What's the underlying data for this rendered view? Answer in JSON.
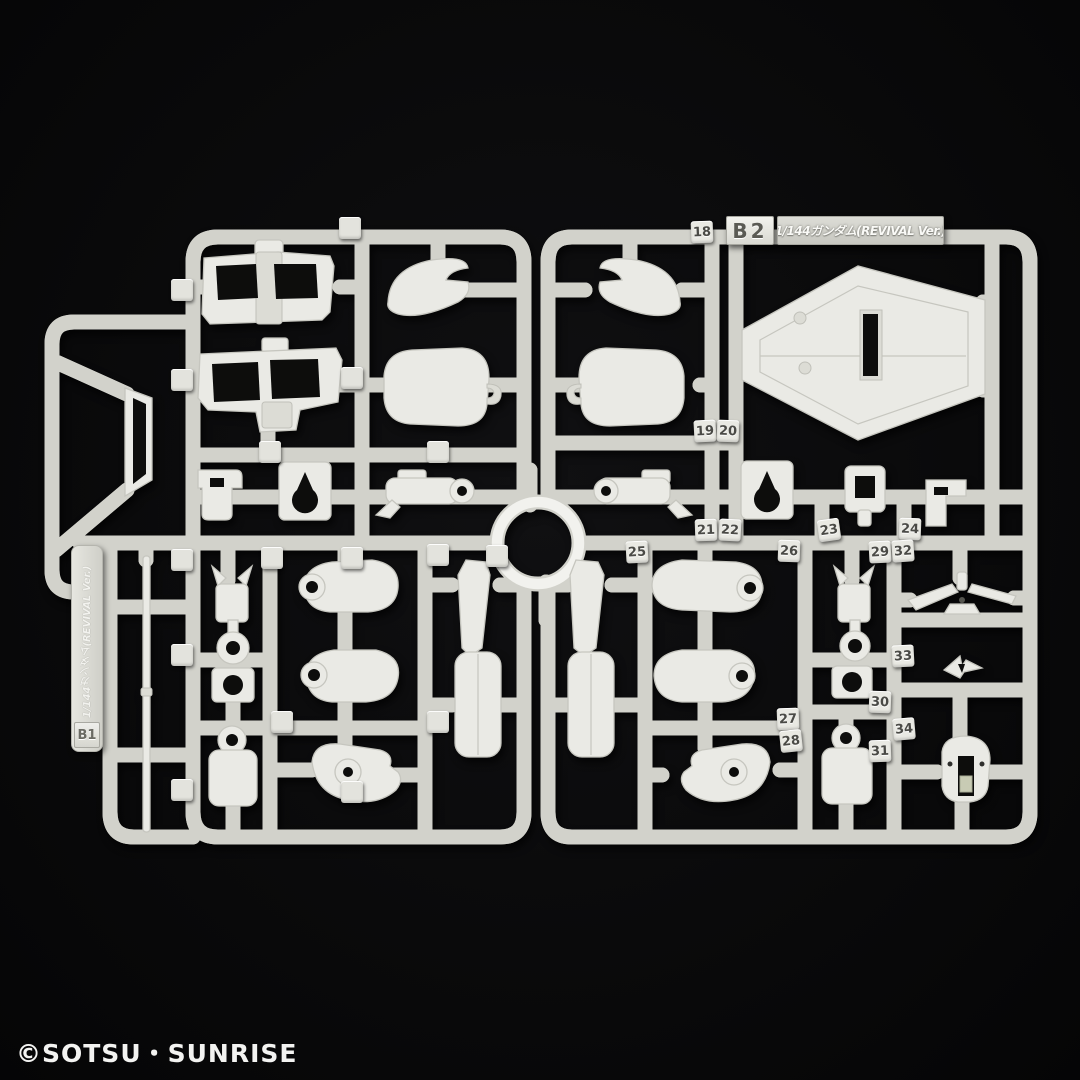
{
  "colors": {
    "background": "#0a0a0b",
    "tube_light": "#f2f2ee",
    "part_fill": "#eaeae5",
    "part_stroke": "#c6c6bf",
    "tag_fill": "#e9e9e3",
    "tag_text": "#4a4a46"
  },
  "runner_b1": {
    "code": "B1",
    "label": "1/144ガンダム(REVIVAL Ver.)"
  },
  "runner_b2": {
    "code": "B2",
    "label": "1/144ガンダム(REVIVAL Ver.)"
  },
  "footer": {
    "copyright": "©SOTSU・SUNRISE"
  },
  "part_number_tags": [
    {
      "n": "18",
      "x": 702,
      "y": 232,
      "r": -2
    },
    {
      "n": "19",
      "x": 705,
      "y": 431,
      "r": -3
    },
    {
      "n": "20",
      "x": 728,
      "y": 431,
      "r": 2
    },
    {
      "n": "21",
      "x": 706,
      "y": 530,
      "r": -2
    },
    {
      "n": "22",
      "x": 730,
      "y": 530,
      "r": 3
    },
    {
      "n": "23",
      "x": 829,
      "y": 530,
      "r": -8
    },
    {
      "n": "24",
      "x": 910,
      "y": 529,
      "r": 2
    },
    {
      "n": "25",
      "x": 637,
      "y": 552,
      "r": -3
    },
    {
      "n": "26",
      "x": 789,
      "y": 551,
      "r": 2
    },
    {
      "n": "27",
      "x": 788,
      "y": 719,
      "r": -2
    },
    {
      "n": "28",
      "x": 791,
      "y": 741,
      "r": -6
    },
    {
      "n": "29",
      "x": 880,
      "y": 552,
      "r": -3
    },
    {
      "n": "30",
      "x": 880,
      "y": 702,
      "r": 2
    },
    {
      "n": "31",
      "x": 880,
      "y": 751,
      "r": -2
    },
    {
      "n": "32",
      "x": 903,
      "y": 551,
      "r": -4
    },
    {
      "n": "33",
      "x": 903,
      "y": 656,
      "r": -3
    },
    {
      "n": "34",
      "x": 904,
      "y": 729,
      "r": -5
    }
  ],
  "embossed_blank_tags": [
    {
      "x": 350,
      "y": 228
    },
    {
      "x": 182,
      "y": 290
    },
    {
      "x": 182,
      "y": 380
    },
    {
      "x": 352,
      "y": 378
    },
    {
      "x": 270,
      "y": 452
    },
    {
      "x": 438,
      "y": 452
    },
    {
      "x": 182,
      "y": 560
    },
    {
      "x": 272,
      "y": 558
    },
    {
      "x": 352,
      "y": 558
    },
    {
      "x": 438,
      "y": 555
    },
    {
      "x": 182,
      "y": 655
    },
    {
      "x": 282,
      "y": 722
    },
    {
      "x": 438,
      "y": 722
    },
    {
      "x": 182,
      "y": 790
    },
    {
      "x": 352,
      "y": 792
    },
    {
      "x": 497,
      "y": 556
    }
  ]
}
